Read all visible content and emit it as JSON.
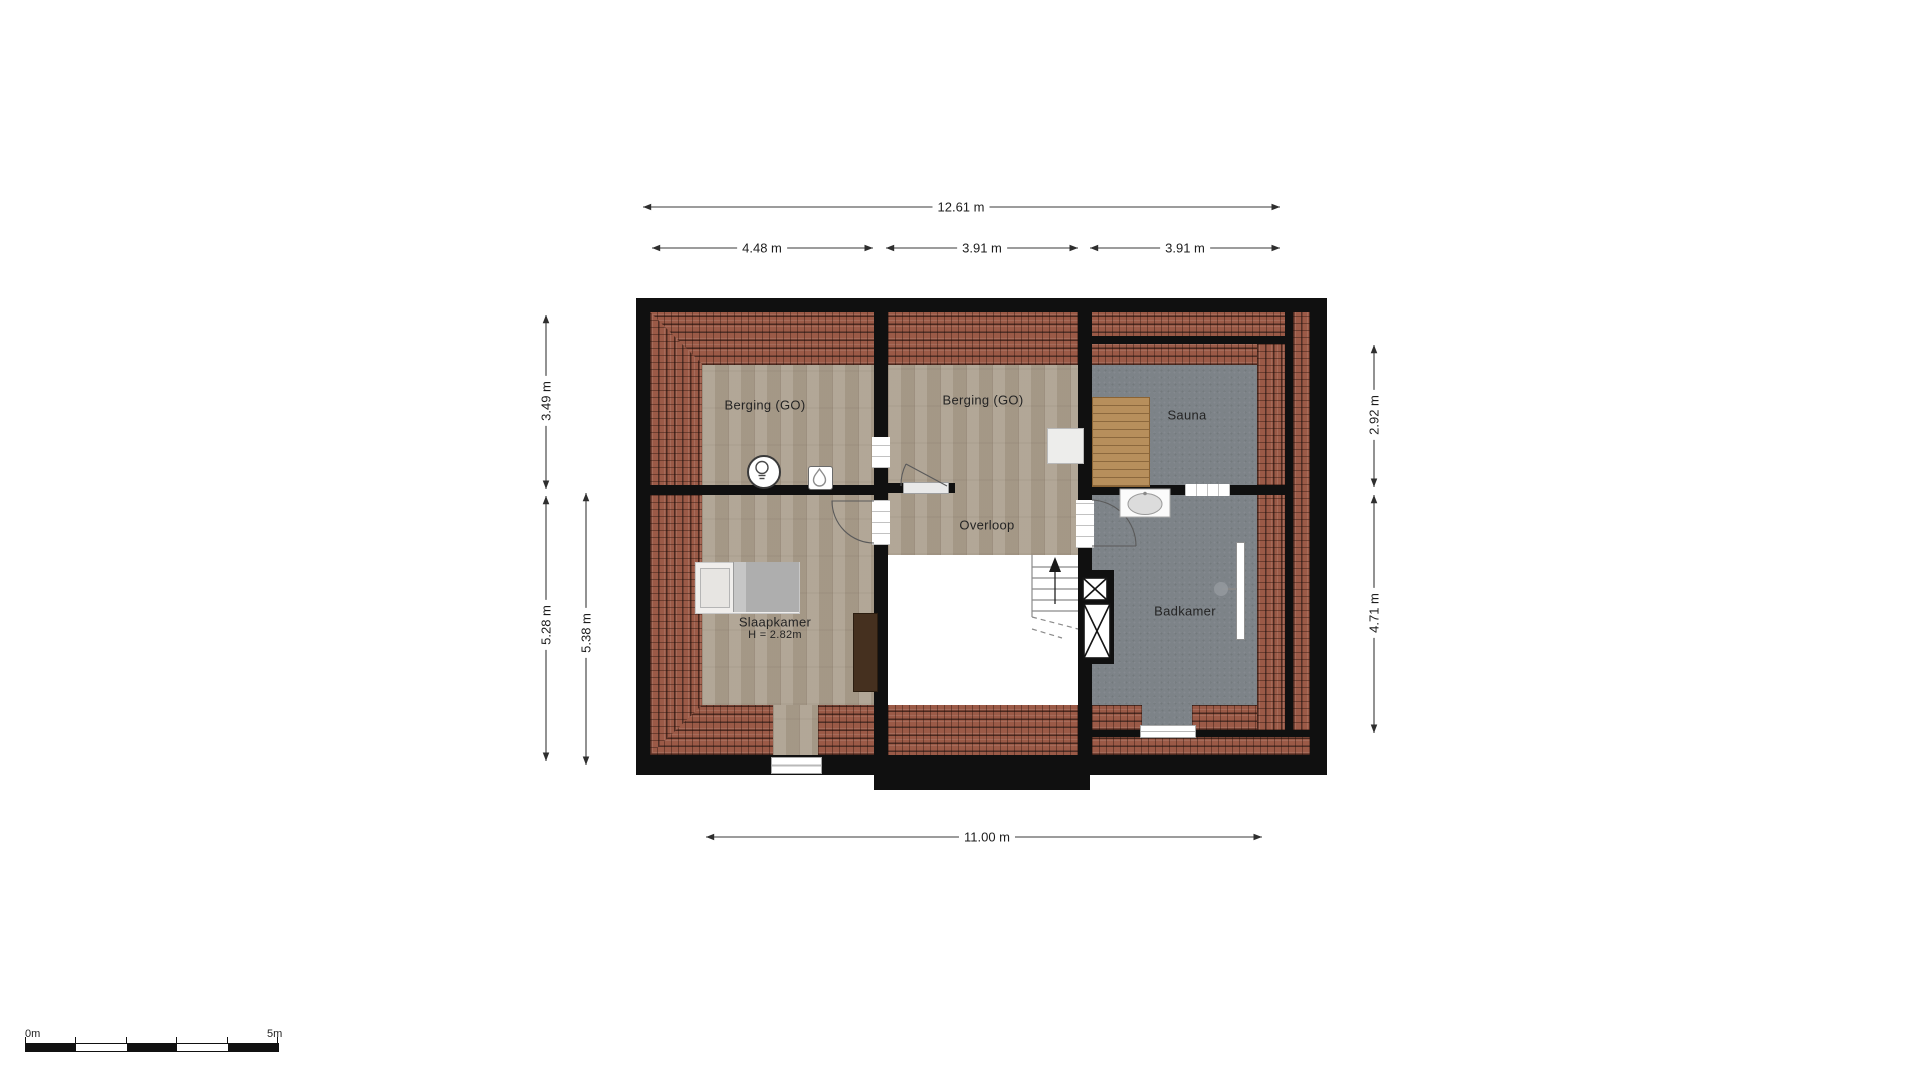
{
  "rooms": {
    "berging1": {
      "label": "Berging (GO)"
    },
    "berging2": {
      "label": "Berging (GO)"
    },
    "sauna": {
      "label": "Sauna"
    },
    "overloop": {
      "label": "Overloop"
    },
    "slaapkamer": {
      "label": "Slaapkamer",
      "height_note": "H = 2.82m"
    },
    "badkamer": {
      "label": "Badkamer"
    }
  },
  "dimensions": {
    "top_total": "12.61 m",
    "top_left": "4.48 m",
    "top_middle": "3.91 m",
    "top_right": "3.91 m",
    "left_upper": "3.49 m",
    "left_lower": "5.28 m",
    "left_inner": "5.38 m",
    "right_upper": "2.92 m",
    "right_lower": "4.71 m",
    "bottom_total": "11.00 m"
  },
  "scale_bar": {
    "start_label": "0m",
    "end_label": "5m"
  },
  "colors": {
    "wall": "#101010",
    "roof_tiles": "#9b5a47",
    "wood_floor": "#aca08f",
    "tile_floor_gray": "#7d8388",
    "sauna_bench": "#b78f5c",
    "dresser": "#45301f"
  }
}
